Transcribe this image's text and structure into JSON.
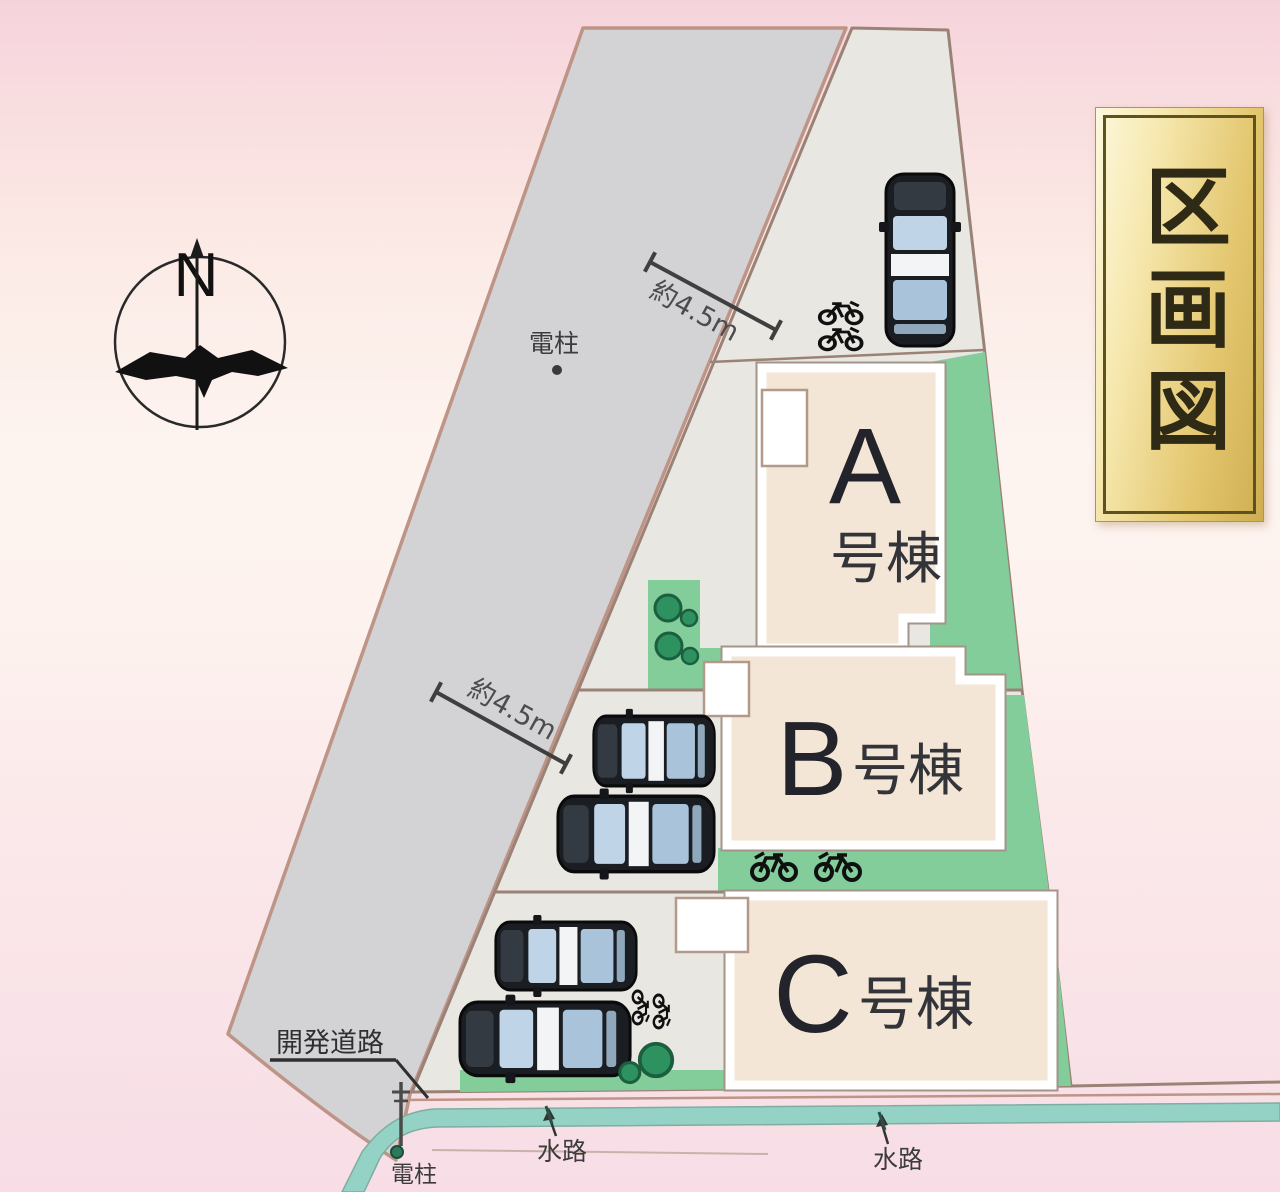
{
  "banner": {
    "title": "区画図"
  },
  "compass": {
    "north": "N"
  },
  "road": {
    "width_labels": [
      "約4.5m",
      "約4.5m"
    ],
    "corner_label": "開発道路"
  },
  "buildings": {
    "a": {
      "letter": "A",
      "suffix": "号棟"
    },
    "b": {
      "letter": "B",
      "suffix": "号棟"
    },
    "c": {
      "letter": "C",
      "suffix": "号棟"
    }
  },
  "annotations": {
    "pole_top": "電柱",
    "pole_bottom": "電柱",
    "water_left": "水路",
    "water_right": "水路"
  },
  "colors": {
    "road": "#d3d2d4",
    "lot": "#e9e7e2",
    "building": "#f3e6d6",
    "green": "#83cd9b",
    "waterway": "#93d2c4",
    "boundary_line": "#bd9486",
    "banner_gold": "#e3c66e",
    "background_pink": "#f8dde6"
  }
}
